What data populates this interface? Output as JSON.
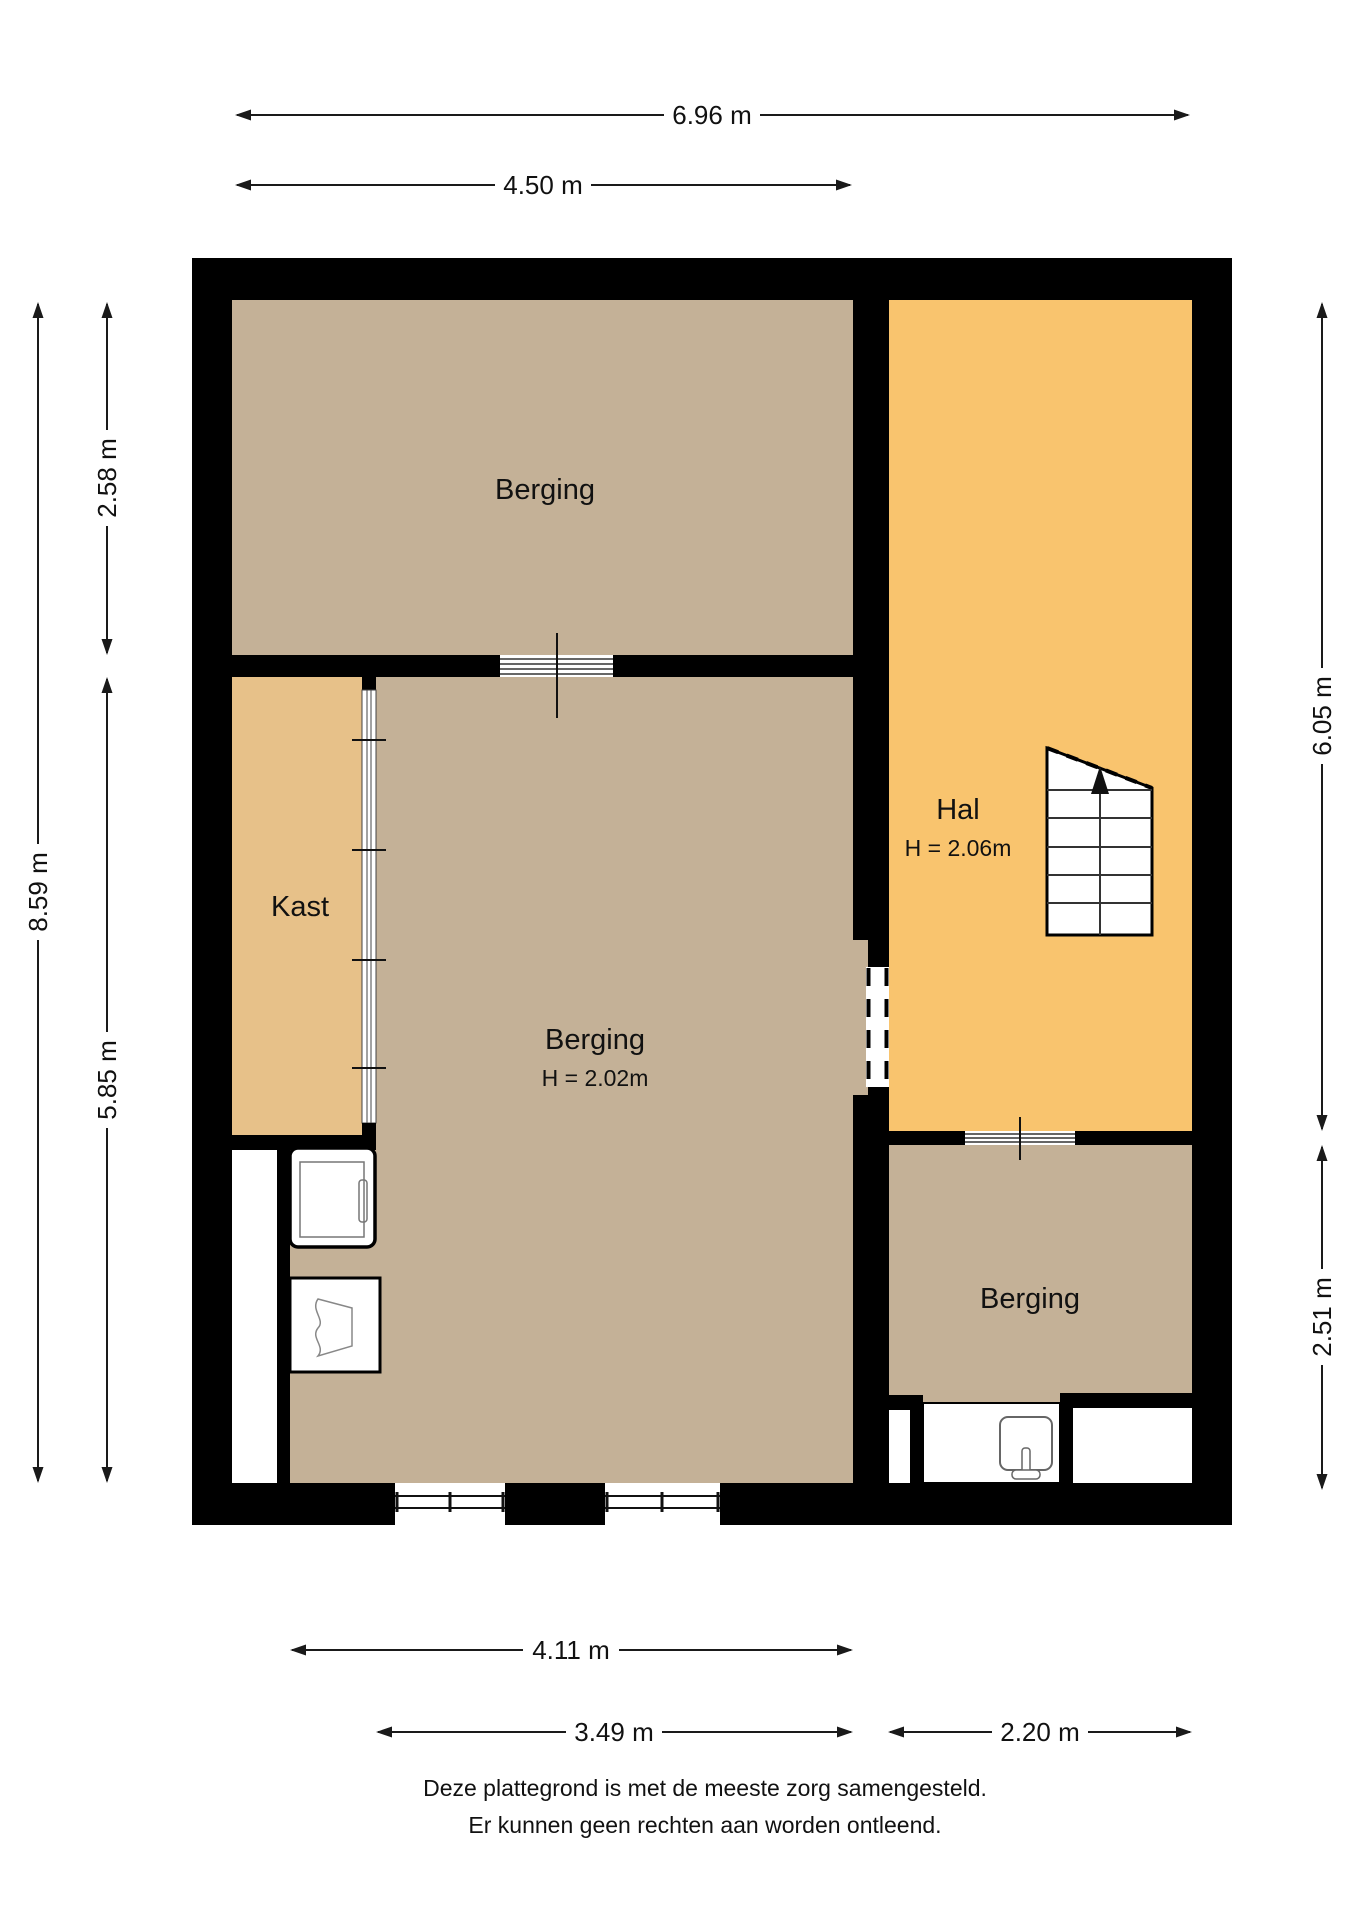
{
  "colors": {
    "floor_storage": "#c4b197",
    "floor_closet": "#e7c189",
    "floor_hall": "#f9c46e"
  },
  "rooms": {
    "berging_top": {
      "label": "Berging"
    },
    "kast": {
      "label": "Kast"
    },
    "berging_main": {
      "label": "Berging",
      "height": "H = 2.02m"
    },
    "hal": {
      "label": "Hal",
      "height": "H = 2.06m"
    },
    "berging_rear": {
      "label": "Berging"
    }
  },
  "dimensions": {
    "top_total": "6.96 m",
    "top_left_section": "4.50 m",
    "left_upper": "2.58 m",
    "left_total": "8.59 m",
    "left_lower": "5.85 m",
    "right_upper": "6.05 m",
    "right_lower": "2.51 m",
    "bottom_main": "4.11 m",
    "bottom_left_section": "3.49 m",
    "bottom_right_section": "2.20 m"
  },
  "footer": {
    "line1": "Deze plattegrond is met de meeste zorg samengesteld.",
    "line2": "Er kunnen geen rechten aan worden ontleend."
  }
}
